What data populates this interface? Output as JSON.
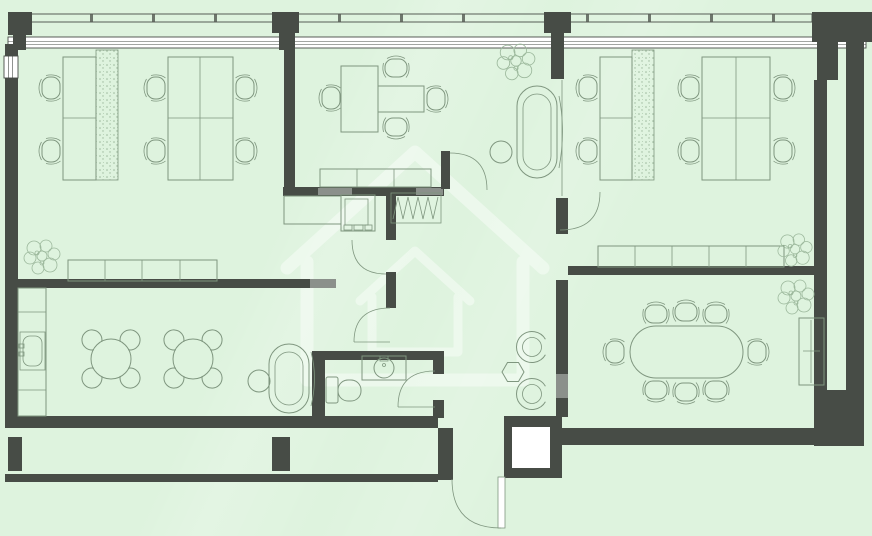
{
  "canvas": {
    "width": 872,
    "height": 536
  },
  "colors": {
    "background": "#def3de",
    "wall": "#474c46",
    "furniture": "#7f967f",
    "accent_speckle": "#9cb89c",
    "door_header": "#8b908b",
    "window_fill": "#ffffff",
    "watermark": "rgba(255,255,255,0.42)"
  },
  "floorplan": {
    "description": "top-down CAD-style office floor plan, no text labels rendered",
    "watermark": "house-logo",
    "rooms": [
      {
        "name": "open-office-left",
        "furniture": {
          "desk_clusters": 2,
          "office_chairs": 6,
          "desk_planter_strip": 1,
          "storage_cabinet_sections": 4,
          "plants": 1
        }
      },
      {
        "name": "manager-office",
        "furniture": {
          "executive_desk": 1,
          "meeting_extension": 1,
          "chairs": 4,
          "credenza_sections": 3
        }
      },
      {
        "name": "lounge",
        "furniture": {
          "sofa": 1,
          "round_side_table": 1,
          "plants": 1
        }
      },
      {
        "name": "open-office-right",
        "furniture": {
          "desk_clusters": 2,
          "office_chairs": 6,
          "desk_planter_strip": 1,
          "storage_cabinet_sections": 5,
          "plants": 2
        }
      },
      {
        "name": "conference-room",
        "furniture": {
          "oval_table": 1,
          "chairs": 8,
          "tall_cabinet": 1,
          "plants": 1
        }
      },
      {
        "name": "break-room",
        "furniture": {
          "round_tables": 2,
          "round_chairs": 8,
          "kitchen_counter": 1,
          "sink": 1,
          "sofa": 1,
          "round_side_table": 1
        }
      },
      {
        "name": "copy-area",
        "furniture": {
          "printer": 1,
          "counter": 1,
          "zigzag_shelf": 1
        }
      },
      {
        "name": "wc-1",
        "furniture": {
          "toilet": 1,
          "sink": 1
        }
      },
      {
        "name": "wc-2",
        "furniture": {
          "round_fixtures": 2,
          "waste_bin": 1
        }
      },
      {
        "name": "hallway",
        "furniture": {}
      },
      {
        "name": "entrance",
        "doors": 1
      }
    ],
    "doors": 6,
    "windows": {
      "north_band": 1,
      "west_band": 1,
      "balcony_rail_north": 1,
      "balcony_south": 1
    }
  }
}
